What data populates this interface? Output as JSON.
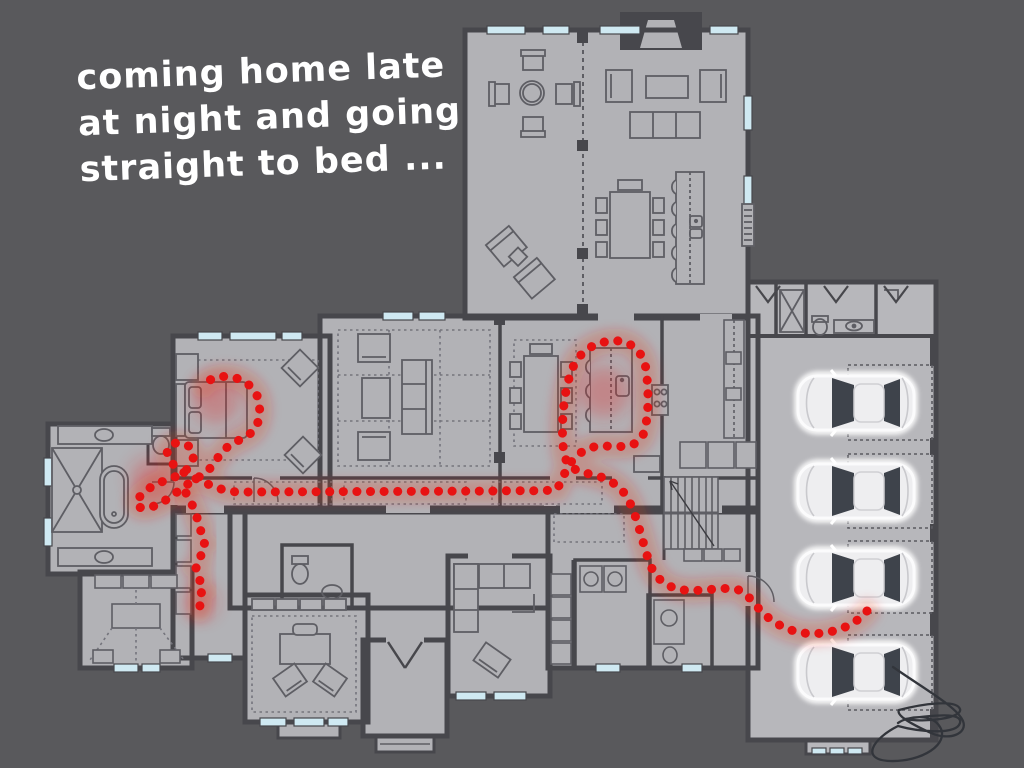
{
  "scene": {
    "type": "floor-plan-meme",
    "background": "#59595c"
  },
  "caption": {
    "lines": [
      "coming home late",
      "at night and going",
      "straight to bed ..."
    ],
    "color": "#ffffff"
  },
  "palette": {
    "floor": "#b2b2b6",
    "floor_light": "#b7b7bb",
    "wall": "#47474c",
    "furniture_line": "#5e5e64",
    "rug_dash": "#74747c",
    "window": "#cfe9f2",
    "path_red": "#e81212",
    "path_glow": "rgba(235,35,25,0.22)",
    "car_body": "#eeeef0",
    "car_window": "#3e434b",
    "car_outline": "#ffffff",
    "signature": "#32353b"
  },
  "path": {
    "dot_diameter": 9,
    "dot_spacing": 13.5,
    "segments": [
      "M867 611 C858 622 842 631 822 633 C800 636 777 628 760 610 C752 601 746 592 736 589 C720 587 700 592 684 590 C668 588 656 580 650 564 C642 542 638 518 628 499 C620 484 605 477 590 474 C577 472 567 467 564 454 C561 434 562 400 570 375 C576 355 590 343 611 341 C630 339 643 351 646 369 C649 392 649 419 643 435 C637 448 621 447 606 446 C592 445 580 451 572 461 C565 470 562 481 557 489 C545 492 520 490 500 491 L240 492 C226 492 214 487 201 481 C188 475 175 469 169 459 C164 449 170 442 180 443 C191 444 196 453 192 462 C188 472 176 477 164 481 C152 485 143 492 138 499 C134 505 139 509 147 508 C158 506 168 499 177 492 C187 484 196 479 205 473 C214 466 217 457 224 450 C233 441 246 439 254 430 C260 422 261 409 258 398 C254 387 244 379 231 377 C219 375 208 379 203 386",
      "M186 493 C191 501 195 511 198 521 C204 528 197 536 205 544 C197 552 205 560 196 568 C204 576 196 584 203 591 C196 597 202 604 199 610"
    ],
    "glow_spots": [
      [
        216,
        400,
        24
      ],
      [
        152,
        479,
        22
      ],
      [
        201,
        602,
        16
      ],
      [
        604,
        392,
        26
      ]
    ]
  },
  "cars": {
    "count": 4,
    "x": 798,
    "length": 116,
    "width": 54,
    "centers_y": [
      403,
      491,
      578,
      672
    ]
  },
  "garage_bays": {
    "x": 848,
    "width": 84,
    "tops_y": [
      365,
      454,
      541,
      635
    ],
    "heights": [
      75,
      74,
      72,
      75
    ]
  },
  "signature": {
    "path": "M893 667 C926 690 957 707 963 721 C968 734 949 741 931 733 C909 723 896 715 899 710 C922 704 956 699 960 709 C963 718 925 723 905 719 C934 715 963 712 960 723 C956 736 916 731 898 726 C872 739 860 760 890 761 C922 762 950 744 940 727 C932 713 908 716 898 723"
  }
}
